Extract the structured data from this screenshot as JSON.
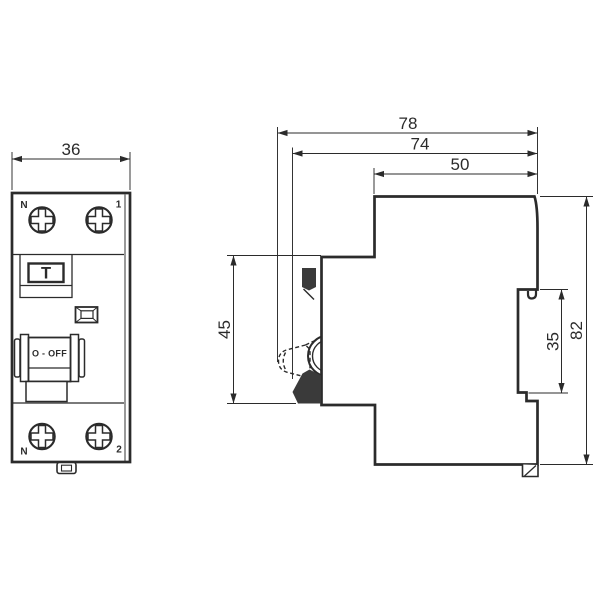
{
  "front_view": {
    "width_dim": "36",
    "terminals": {
      "top_left": "N",
      "top_right": "1",
      "bottom_left": "N",
      "bottom_right": "2"
    },
    "test_button": "T",
    "switch_state": "O - OFF"
  },
  "side_view": {
    "overall_depth": "78",
    "body_depth": "74",
    "upper_depth": "50",
    "front_height": "45",
    "rail_recess_height": "35",
    "overall_height": "82"
  },
  "colors": {
    "line": "#2b2b2b",
    "solid_fill": "#3a3a3a",
    "background": "#ffffff"
  }
}
